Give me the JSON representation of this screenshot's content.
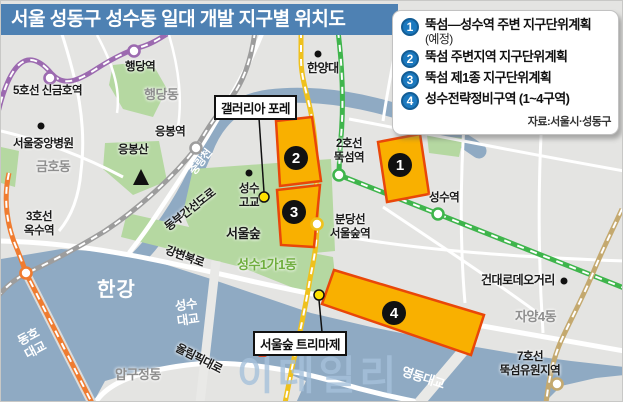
{
  "title": "서울 성동구 성수동 일대 개발 지구별 위치도",
  "legend": {
    "items": [
      {
        "num": "1",
        "label": "뚝섬―성수역 주변 지구단위계획",
        "sub": "(예정)"
      },
      {
        "num": "2",
        "label": "뚝섬 주변지역 지구단위계획",
        "sub": ""
      },
      {
        "num": "3",
        "label": "뚝섬 제1종 지구단위계획",
        "sub": ""
      },
      {
        "num": "4",
        "label": "성수전략정비구역 (1~4구역)",
        "sub": ""
      }
    ],
    "source": "자료:서울시·성동구"
  },
  "zone_badges": {
    "z1": "1",
    "z2": "2",
    "z3": "3",
    "z4": "4"
  },
  "callouts": {
    "galleria": "갤러리아 포레",
    "trimaje": "서울숲 트리마제"
  },
  "labels": {
    "line5_singeumho": "5호선 신금호역",
    "haengdang_station": "행당역",
    "haengdang_dong": "행당동",
    "hanyang": "한양대",
    "hospital": "서울중앙병원",
    "geumho": "금호동",
    "eungbong_station": "응봉역",
    "eungbong_mt": "응봉산",
    "oksu_station": "3호선\n옥수역",
    "jungnangcheon": "중랑천",
    "dongbu_expwy": "동부간선도로",
    "ttukseom_station": "2호선\n뚝섬역",
    "seoulsup_station": "분당선\n서울숲역",
    "seongsu_station": "성수역",
    "seongsu_hs": "성수\n고교",
    "seoulsup_park": "서울숲",
    "seongsu1ga1": "성수1가1동",
    "gangbyeon_expwy": "강변북로",
    "hangang": "한강",
    "dongho_bridge": "동호\n대교",
    "seongsu_bridge": "성수\n대교",
    "apgujeong": "압구정동",
    "olympic_expwy": "올림픽대로",
    "yeongdong_bridge": "영동대교",
    "jayang4": "자양4동",
    "kondae_rodeo": "건대로데오거리",
    "ttukseom_resort": "7호선\n뚝섬유원지역"
  },
  "watermark": "이데일리",
  "colors": {
    "title_bar": "#4e81b3",
    "legend_badge": "#1b79bf",
    "zone_fill": "#f9b000",
    "zone_stroke": "#e94709",
    "water": "#8faac3",
    "park": "#b5d8a1",
    "line2_green": "#3fb54c",
    "line3_orange": "#f07c30",
    "line5_purple": "#9c6ab0",
    "line7_tan": "#c4a96f",
    "bundang_yellow": "#efc11d",
    "jungang_gray": "#9d9d9d",
    "marker_yellow": "#ffe200"
  }
}
